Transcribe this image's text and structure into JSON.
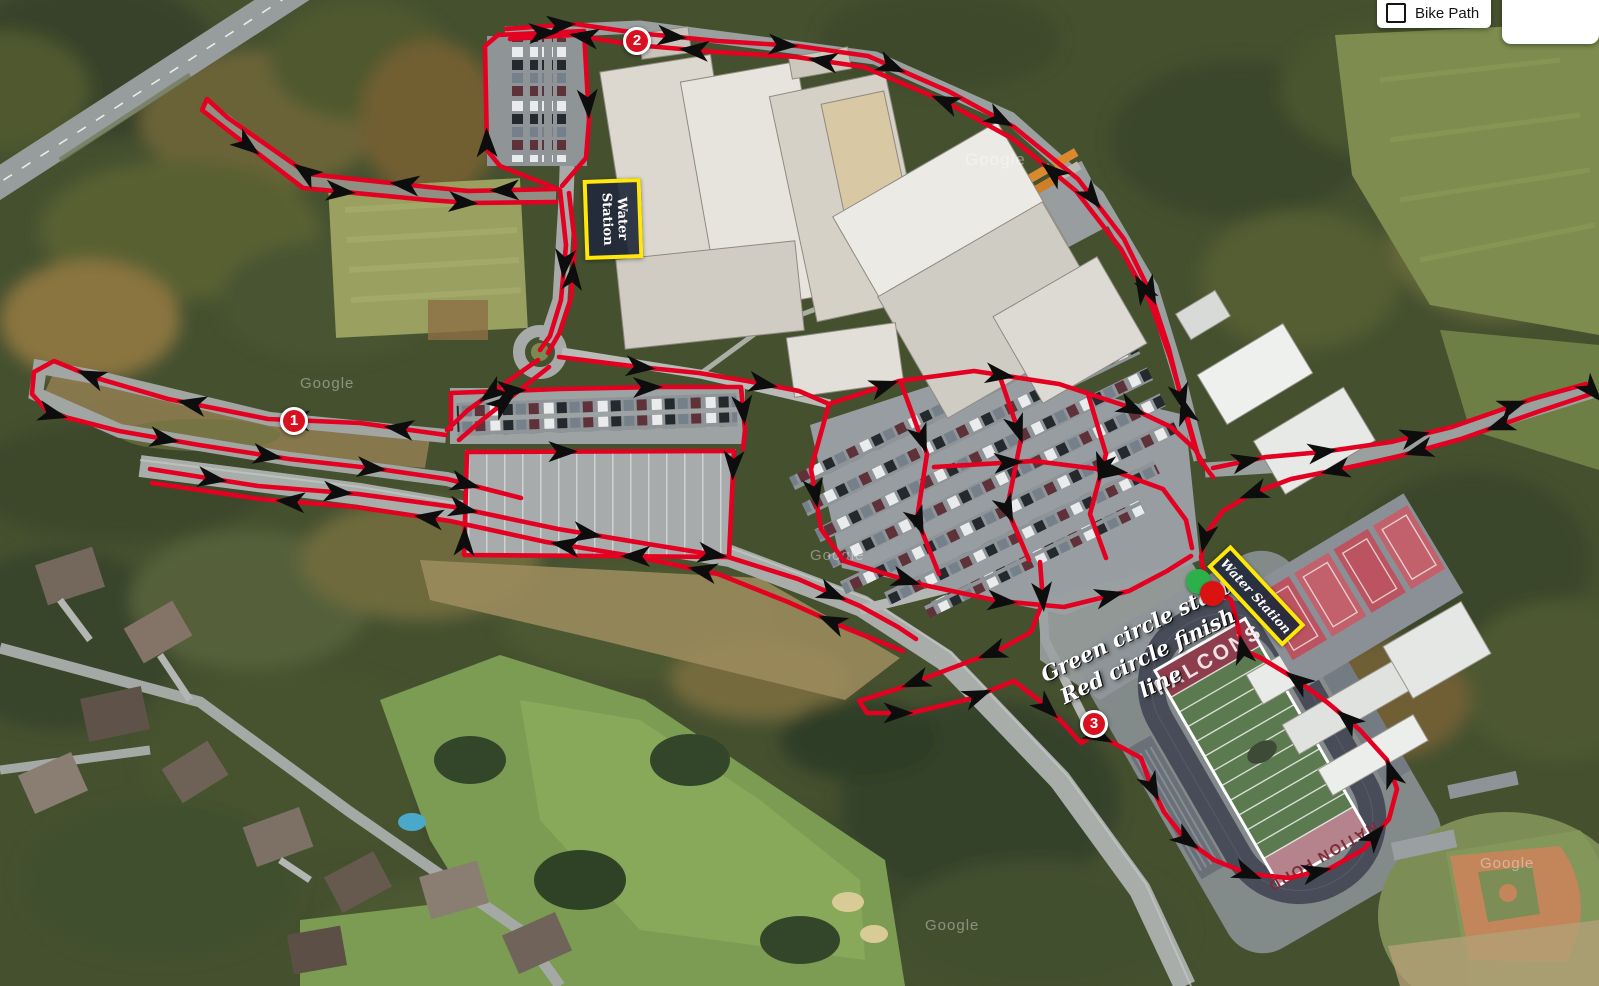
{
  "map_controls": {
    "bike_path_label": "Bike Path",
    "satellite_label": "Satellite"
  },
  "legend": {
    "line1": "Green circle start",
    "line2": "Red circle finish line"
  },
  "water_stations": [
    {
      "label": "Water Station"
    },
    {
      "label": "Water Station"
    }
  ],
  "markers": [
    {
      "number": "1",
      "x": 294,
      "y": 421
    },
    {
      "number": "2",
      "x": 637,
      "y": 41
    },
    {
      "number": "3",
      "x": 1094,
      "y": 724
    }
  ],
  "start_finish": {
    "start_color": "#2cb14a",
    "finish_color": "#da1212",
    "start": {
      "x": 1198,
      "y": 581
    },
    "finish": {
      "x": 1212,
      "y": 593
    }
  },
  "field_text": {
    "home_end_zone": "FALCONS",
    "far_end_zone": "NATION FORD"
  },
  "watermark": "Google",
  "route": {
    "color": "#e30021",
    "arrow_color": "#0d0d0d",
    "width": 4.6,
    "segments": [
      {
        "points": [
          [
            558,
            189
          ],
          [
            468,
            191
          ],
          [
            428,
            187
          ],
          [
            308,
            174
          ],
          [
            228,
            118
          ],
          [
            207,
            99
          ],
          [
            202,
            110
          ],
          [
            230,
            132
          ],
          [
            303,
            188
          ],
          [
            428,
            200
          ],
          [
            470,
            203
          ],
          [
            556,
            202
          ]
        ],
        "arrows": [
          0.07,
          0.2,
          0.33,
          0.58,
          0.72,
          0.88
        ]
      },
      {
        "points": [
          [
            558,
            189
          ],
          [
            500,
            166
          ],
          [
            487,
            150
          ],
          [
            485,
            46
          ],
          [
            498,
            35
          ],
          [
            584,
            31
          ],
          [
            589,
            120
          ],
          [
            586,
            158
          ],
          [
            562,
            186
          ]
        ],
        "arrows": [
          0.2,
          0.55,
          0.8
        ]
      },
      {
        "points": [
          [
            560,
            190
          ],
          [
            566,
            245
          ],
          [
            561,
            300
          ],
          [
            550,
            336
          ],
          [
            540,
            350
          ]
        ],
        "arrows": [
          0.45
        ]
      },
      {
        "points": [
          [
            548,
            353
          ],
          [
            560,
            332
          ],
          [
            571,
            298
          ],
          [
            575,
            244
          ],
          [
            569,
            193
          ]
        ],
        "arrows": [
          0.5
        ]
      },
      {
        "points": [
          [
            506,
            29
          ],
          [
            575,
            24
          ],
          [
            637,
            33
          ],
          [
            718,
            41
          ],
          [
            798,
            46
          ],
          [
            868,
            56
          ],
          [
            948,
            91
          ],
          [
            1014,
            127
          ],
          [
            1078,
            179
          ],
          [
            1124,
            239
          ],
          [
            1151,
            294
          ],
          [
            1169,
            349
          ],
          [
            1184,
            409
          ],
          [
            1196,
            451
          ],
          [
            1206,
            468
          ]
        ],
        "arrows": [
          0.06,
          0.18,
          0.3,
          0.42,
          0.55,
          0.68,
          0.8,
          0.92
        ]
      },
      {
        "points": [
          [
            1213,
            477
          ],
          [
            1199,
            459
          ],
          [
            1186,
            413
          ],
          [
            1170,
            357
          ],
          [
            1151,
            304
          ],
          [
            1121,
            249
          ],
          [
            1076,
            191
          ],
          [
            1013,
            139
          ],
          [
            946,
            102
          ],
          [
            864,
            67
          ],
          [
            796,
            57
          ],
          [
            716,
            52
          ],
          [
            635,
            45
          ],
          [
            573,
            35
          ],
          [
            510,
            39
          ]
        ],
        "arrows": [
          0.08,
          0.22,
          0.38,
          0.52,
          0.66,
          0.8,
          0.92
        ]
      },
      {
        "points": [
          [
            1213,
            468
          ],
          [
            1266,
            457
          ],
          [
            1322,
            452
          ],
          [
            1391,
            442
          ],
          [
            1452,
            427
          ],
          [
            1532,
            399
          ],
          [
            1586,
            384
          ],
          [
            1594,
            393
          ],
          [
            1540,
            411
          ],
          [
            1461,
            439
          ],
          [
            1396,
            457
          ],
          [
            1341,
            469
          ],
          [
            1291,
            479
          ],
          [
            1251,
            494
          ],
          [
            1223,
            511
          ],
          [
            1206,
            534
          ],
          [
            1201,
            557
          ],
          [
            1204,
            572
          ]
        ],
        "arrows": [
          0.04,
          0.13,
          0.24,
          0.36,
          0.46,
          0.58,
          0.68,
          0.78,
          0.88,
          0.96
        ]
      },
      {
        "points": [
          [
            446,
            435
          ],
          [
            360,
            423
          ],
          [
            268,
            419
          ],
          [
            168,
            399
          ],
          [
            93,
            377
          ],
          [
            54,
            361
          ],
          [
            34,
            372
          ],
          [
            32,
            394
          ],
          [
            49,
            413
          ],
          [
            119,
            431
          ],
          [
            199,
            445
          ],
          [
            289,
            459
          ],
          [
            379,
            469
          ],
          [
            447,
            479
          ],
          [
            521,
            498
          ]
        ],
        "arrows": [
          0.05,
          0.16,
          0.27,
          0.38,
          0.5,
          0.62,
          0.73,
          0.84,
          0.94
        ]
      },
      {
        "points": [
          [
            538,
            360
          ],
          [
            504,
            384
          ],
          [
            468,
            410
          ],
          [
            447,
            430
          ]
        ],
        "arrows": [
          0.5
        ]
      },
      {
        "points": [
          [
            459,
            440
          ],
          [
            482,
            420
          ],
          [
            516,
            393
          ],
          [
            549,
            367
          ]
        ],
        "arrows": [
          0.5
        ]
      },
      {
        "points": [
          [
            150,
            469
          ],
          [
            258,
            486
          ],
          [
            358,
            494
          ],
          [
            454,
            507
          ],
          [
            558,
            529
          ],
          [
            648,
            544
          ],
          [
            728,
            557
          ],
          [
            798,
            579
          ],
          [
            860,
            606
          ],
          [
            898,
            627
          ],
          [
            916,
            639
          ]
        ],
        "arrows": [
          0.08,
          0.24,
          0.4,
          0.56,
          0.72,
          0.88
        ]
      },
      {
        "points": [
          [
            903,
            651
          ],
          [
            848,
            629
          ],
          [
            788,
            602
          ],
          [
            718,
            574
          ],
          [
            638,
            557
          ],
          [
            546,
            542
          ],
          [
            450,
            521
          ],
          [
            356,
            507
          ],
          [
            260,
            499
          ],
          [
            152,
            483
          ]
        ],
        "arrows": [
          0.1,
          0.28,
          0.46,
          0.64,
          0.82
        ]
      },
      {
        "points": [
          [
            1040,
            562
          ],
          [
            1043,
            601
          ],
          [
            1031,
            632
          ],
          [
            997,
            651
          ],
          [
            944,
            671
          ],
          [
            897,
            689
          ],
          [
            859,
            701
          ],
          [
            867,
            713
          ],
          [
            911,
            713
          ],
          [
            969,
            699
          ],
          [
            1014,
            681
          ],
          [
            1040,
            701
          ],
          [
            1063,
            723
          ],
          [
            1081,
            743
          ],
          [
            1096,
            734
          ],
          [
            1121,
            747
          ],
          [
            1141,
            758
          ]
        ],
        "arrows": [
          0.06,
          0.2,
          0.34,
          0.52,
          0.66,
          0.8,
          0.92
        ]
      },
      {
        "points": [
          [
            1141,
            758
          ],
          [
            1150,
            783
          ],
          [
            1164,
            812
          ],
          [
            1184,
            838
          ],
          [
            1214,
            860
          ],
          [
            1249,
            874
          ],
          [
            1289,
            878
          ],
          [
            1329,
            869
          ],
          [
            1364,
            849
          ],
          [
            1389,
            819
          ],
          [
            1397,
            789
          ],
          [
            1387,
            760
          ],
          [
            1360,
            730
          ],
          [
            1328,
            703
          ],
          [
            1294,
            678
          ],
          [
            1261,
            658
          ],
          [
            1243,
            650
          ],
          [
            1237,
            622
          ],
          [
            1231,
            600
          ],
          [
            1220,
            593
          ]
        ],
        "arrows": [
          0.05,
          0.15,
          0.26,
          0.37,
          0.48,
          0.59,
          0.7,
          0.8,
          0.9
        ]
      },
      {
        "points": [
          [
            559,
            357
          ],
          [
            639,
            367
          ],
          [
            699,
            373
          ],
          [
            747,
            381
          ],
          [
            799,
            391
          ],
          [
            829,
            404
          ]
        ],
        "arrows": [
          0.3,
          0.75
        ]
      },
      {
        "points": [
          [
            451,
            429
          ],
          [
            451,
            393
          ],
          [
            559,
            389
          ],
          [
            659,
            387
          ],
          [
            741,
            387
          ],
          [
            745,
            430
          ],
          [
            743,
            449
          ]
        ],
        "arrows": [
          0.25,
          0.6,
          0.9
        ]
      },
      {
        "points": [
          [
            467,
            452
          ],
          [
            734,
            451
          ],
          [
            729,
            557
          ],
          [
            464,
            555
          ]
        ],
        "closed": true,
        "arrows": [
          0.13,
          0.38,
          0.63,
          0.88
        ]
      },
      {
        "points": [
          [
            829,
            404
          ],
          [
            899,
            381
          ],
          [
            974,
            371
          ],
          [
            1059,
            384
          ],
          [
            1129,
            407
          ],
          [
            1171,
            427
          ],
          [
            1197,
            451
          ]
        ],
        "arrows": [
          0.15,
          0.45,
          0.8
        ]
      },
      {
        "points": [
          [
            829,
            404
          ],
          [
            811,
            469
          ],
          [
            821,
            529
          ],
          [
            844,
            561
          ]
        ],
        "arrows": [
          0.55
        ]
      },
      {
        "points": [
          [
            844,
            561
          ],
          [
            919,
            584
          ],
          [
            999,
            601
          ],
          [
            1064,
            607
          ],
          [
            1129,
            591
          ],
          [
            1167,
            571
          ],
          [
            1191,
            556
          ]
        ],
        "arrows": [
          0.18,
          0.45,
          0.75
        ]
      },
      {
        "points": [
          [
            901,
            383
          ],
          [
            927,
            454
          ],
          [
            917,
            519
          ],
          [
            939,
            574
          ]
        ],
        "arrows": [
          0.3,
          0.72
        ]
      },
      {
        "points": [
          [
            999,
            374
          ],
          [
            1021,
            439
          ],
          [
            1007,
            509
          ],
          [
            1029,
            560
          ]
        ],
        "arrows": [
          0.3,
          0.72
        ]
      },
      {
        "points": [
          [
            1088,
            394
          ],
          [
            1106,
            454
          ],
          [
            1090,
            514
          ],
          [
            1106,
            558
          ]
        ],
        "arrows": [
          0.45
        ]
      },
      {
        "points": [
          [
            934,
            467
          ],
          [
            1034,
            461
          ],
          [
            1114,
            471
          ],
          [
            1163,
            489
          ],
          [
            1186,
            520
          ],
          [
            1192,
            548
          ]
        ],
        "arrows": [
          0.25,
          0.6
        ]
      }
    ]
  }
}
